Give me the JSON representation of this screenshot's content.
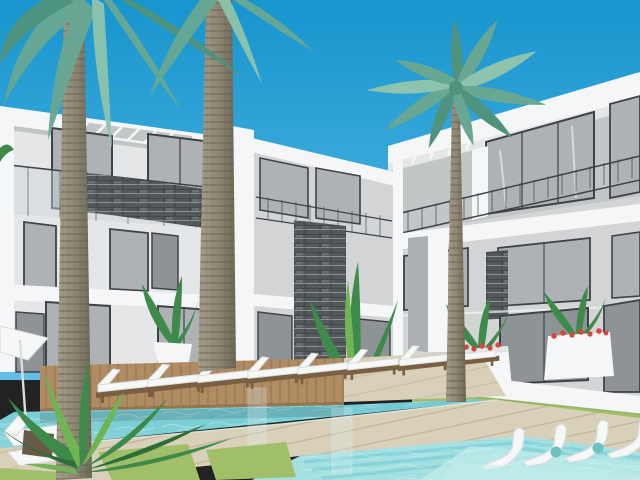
{
  "scene": {
    "kind": "3d-architectural-render",
    "subject": "modern three-story resort apartment complex with swimming pools",
    "inventory": {
      "buildings": 2,
      "floors_per_building": 3,
      "palm_trees": 3,
      "pools": 2,
      "deck_loungers": 8,
      "in_pool_loungers": 5,
      "corner_loungers": 2,
      "planters_with_red_flowers": 2,
      "potted_plants": 3,
      "parasols": 1,
      "grass_patches": 3
    }
  },
  "palette": {
    "sky-top": "#1795ce",
    "sky-low": "#63bfe7",
    "wall-white": "#f5f6f7",
    "wall-light": "#e4e6e7",
    "wall-mid": "#d2d4d5",
    "wall-shade": "#c3c6c7",
    "wall-dark": "#abafb1",
    "frame-dark": "#3f4347",
    "glass": "#aeb2b4",
    "glass-light": "#ccd4d6",
    "glass-dark": "#8e9396",
    "stone-dark": "#53585b",
    "stone-light": "#9ba0a3",
    "water-deep": "#72c9d2",
    "water-mid": "#8ad6da",
    "water-light": "#a5e1e2",
    "water-shelf": "#c0ecea",
    "deck": "#d9d0ba",
    "deck-line": "#b6ac92",
    "platform": "#b08c63",
    "platform-line": "#8f7050",
    "platform-edge": "#96764f",
    "grass": "#a0bf68",
    "grass-dark": "#7da24f",
    "trunk": "#8e8674",
    "trunk-dark": "#6e6757",
    "trunk-ring": "#5f5949",
    "trunk-light": "#a89f8a",
    "frond": "#68a893",
    "frond-dark": "#4f937e",
    "frond-light": "#8ec4ad",
    "plant": "#3d8a4a",
    "plant-light": "#6fb554",
    "plant-dark": "#2d6e38",
    "flower-red": "#d8453f",
    "cushion": "#f6f7f7",
    "cushion-shade": "#d9dddd",
    "wood-frame": "#7a5f42",
    "wood-dark": "#6b5948",
    "teal-table": "#6cc3c0",
    "shadow": "#000000"
  }
}
